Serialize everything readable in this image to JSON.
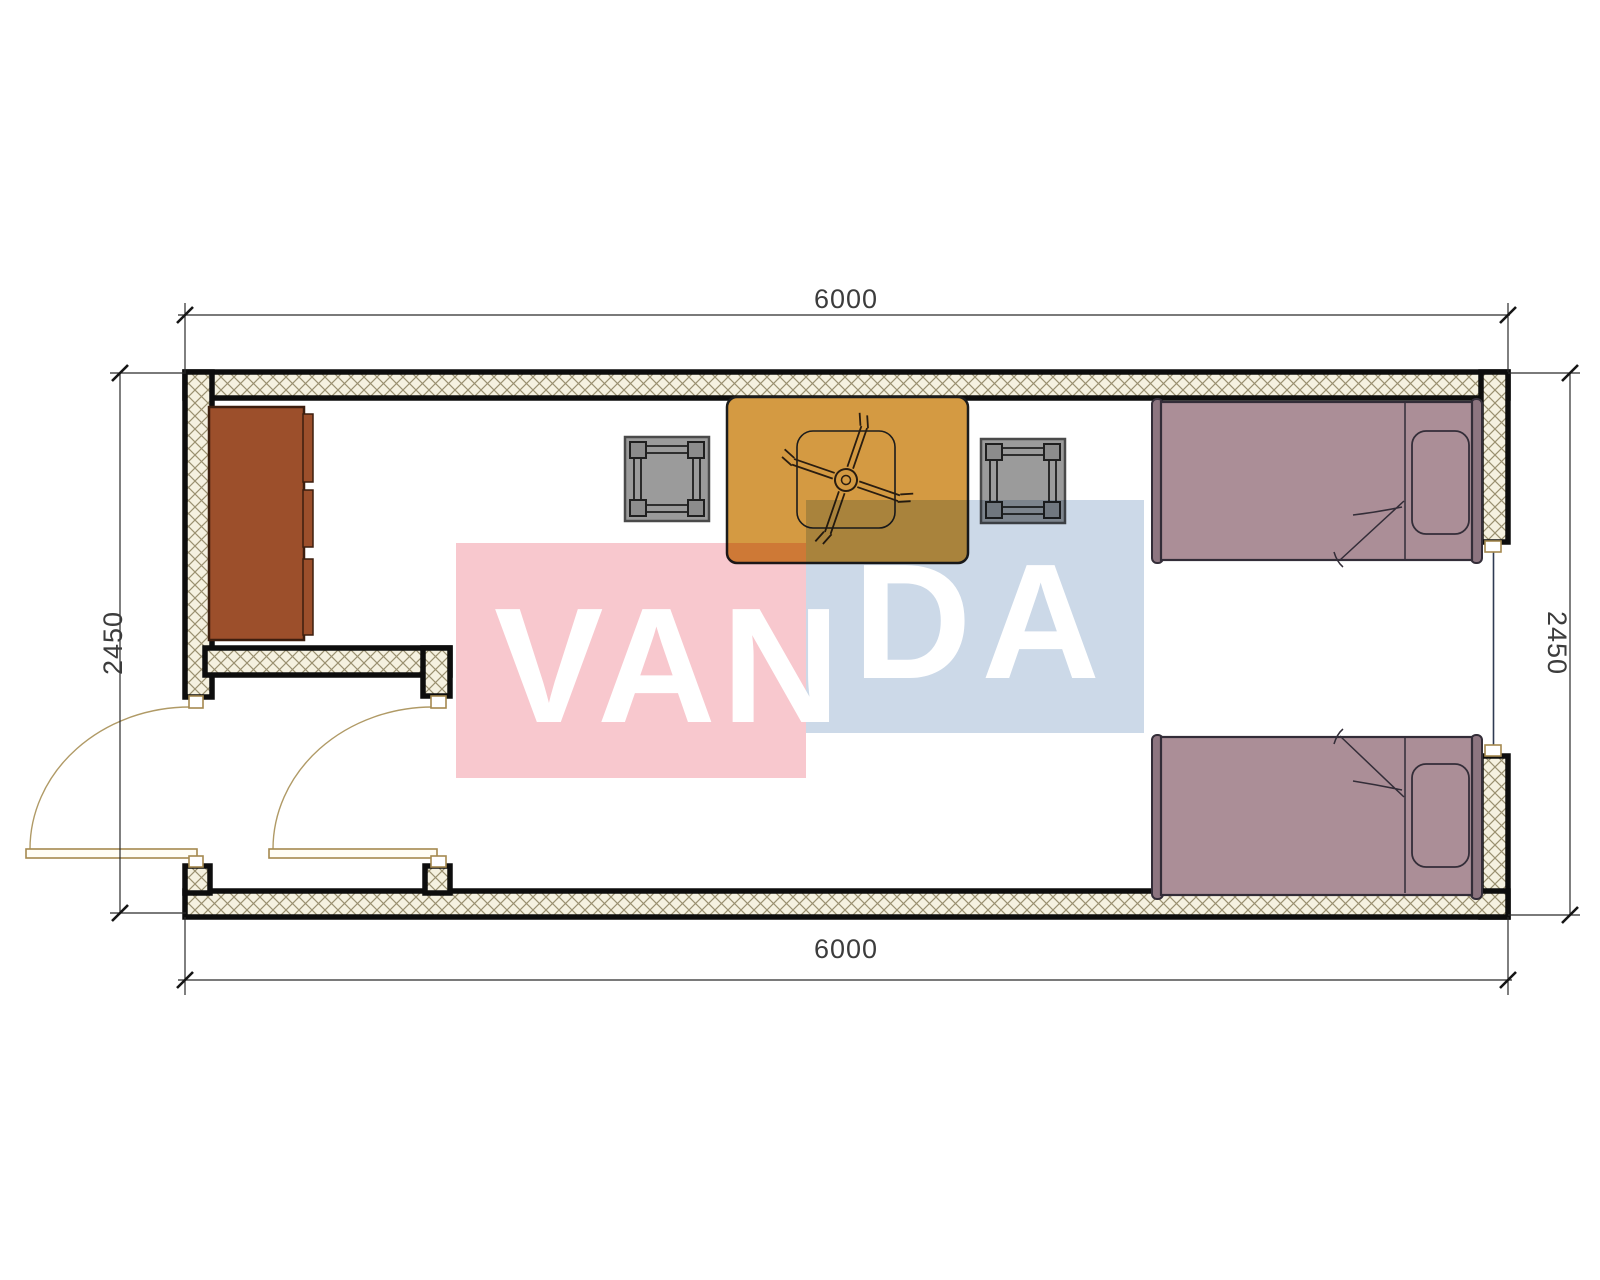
{
  "drawing": {
    "type": "container-house-floor-plan",
    "dimensions": {
      "top": "6000",
      "bottom": "6000",
      "left": "2450",
      "right": "2450"
    },
    "watermark": {
      "full_text": "VANDA",
      "part1": "VAN",
      "part2": "DA",
      "pink_color": "#f8c8ce",
      "blue_color": "#ccd9e8",
      "letter_color": "#ffffff"
    },
    "colors": {
      "wall_hatch_bg": "#f5f1e0",
      "wall_hatch_line": "#9a9070",
      "wall_outline": "#0d0d0d",
      "wardrobe": "#9c4f2b",
      "wardrobe_outline": "#3d1e0e",
      "table": "#d49a42",
      "table_outline": "#1c1c1c",
      "stool": "#9b9b9b",
      "stool_corner": "#8c8c8c",
      "bed": "#ab8e97",
      "bed_cap": "#8d7580",
      "bed_outline": "#332d38",
      "door": "#a5894f",
      "door_leaf_fill": "#fffdf5",
      "window_line": "#2f3a52",
      "dim_line": "#2b2b2b"
    }
  }
}
